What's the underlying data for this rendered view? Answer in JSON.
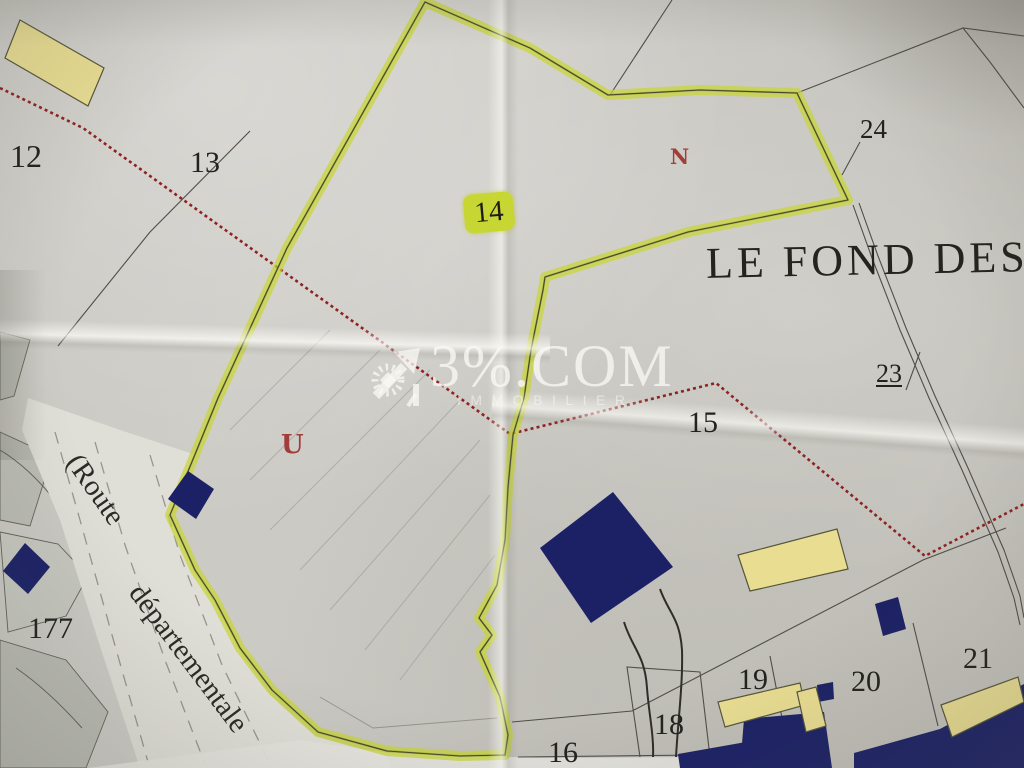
{
  "colors": {
    "paper": "#c9c7c1",
    "paper_dark": "#babbb3",
    "road_fill": "#dfded7",
    "highlight": "#c8d634",
    "highlight_core": "#76830f",
    "line": "#4f4e47",
    "red_path": "#8e2222",
    "red_letter": "#a03f3a",
    "navy": "#1c2166",
    "beige": "#e9dd92",
    "beige_outline": "#56553b",
    "label_ink": "#22221e",
    "white_margin": "#e4e3dd"
  },
  "title": {
    "text": "LE FOND DES B"
  },
  "watermark": {
    "brand": "3%.COM",
    "subtitle": "IMMOBILIER",
    "logo": "house-arrow-stamp-icon"
  },
  "road": {
    "label_line1": "(Route",
    "label_line2": "départementale"
  },
  "highlighted_label": {
    "text": "14"
  },
  "parcel_labels": [
    {
      "text": "12",
      "x": 10,
      "y": 140,
      "size": 32
    },
    {
      "text": "13",
      "x": 190,
      "y": 148,
      "size": 30
    },
    {
      "text": "15",
      "x": 688,
      "y": 408,
      "size": 30
    },
    {
      "text": "16",
      "x": 548,
      "y": 738,
      "size": 30
    },
    {
      "text": "18",
      "x": 654,
      "y": 710,
      "size": 30
    },
    {
      "text": "19",
      "x": 738,
      "y": 665,
      "size": 30
    },
    {
      "text": "20",
      "x": 851,
      "y": 667,
      "size": 30
    },
    {
      "text": "21",
      "x": 963,
      "y": 644,
      "size": 30
    },
    {
      "text": "23",
      "x": 876,
      "y": 361,
      "size": 26,
      "underline": true
    },
    {
      "text": "24",
      "x": 860,
      "y": 116,
      "size": 27
    },
    {
      "text": "177",
      "x": 28,
      "y": 614,
      "size": 30
    }
  ],
  "zone_letters": [
    {
      "text": "N",
      "x": 670,
      "y": 146,
      "size": 21
    },
    {
      "text": "U",
      "x": 281,
      "y": 432,
      "size": 26
    }
  ]
}
